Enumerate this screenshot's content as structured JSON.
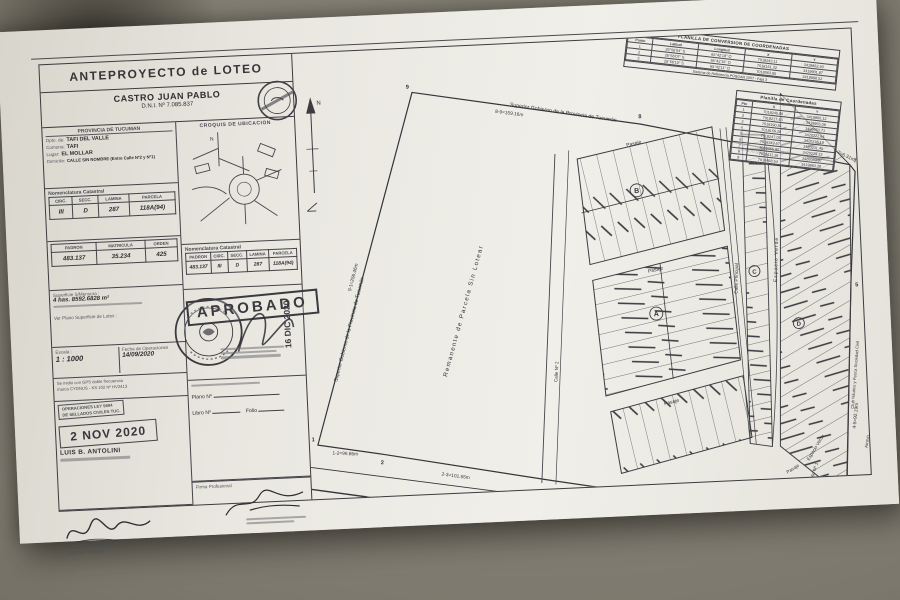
{
  "sheet": {
    "title": "ANTEPROYECTO de LOTEO",
    "owner": {
      "name": "CASTRO JUAN PABLO",
      "dni": "D.N.I. Nº 7.085.837"
    },
    "location": {
      "province": "PROVINCIA DE TUCUMAN",
      "rows": [
        {
          "label": "Dpto. de:",
          "value": "TAFI DEL VALLE"
        },
        {
          "label": "Comuna:",
          "value": "TAFI"
        },
        {
          "label": "Lugar:",
          "value": "EL MOLLAR"
        },
        {
          "label": "Domicilio:",
          "value": "CALLE SIN NOMBRE (Entre Calle Nº2 y Nº1)"
        }
      ]
    },
    "croquis_title": "CROQUIS DE UBICACION",
    "nomenclatura": {
      "title": "Nomenclatura Catastral",
      "headers": [
        "CIRC.",
        "SECC.",
        "LAMINA",
        "PARCELA"
      ],
      "values": [
        "III",
        "D",
        "287",
        "118A(94)"
      ]
    },
    "padron_table": {
      "headers": [
        "PADRON",
        "MATRICULA",
        "ORDEN"
      ],
      "values": [
        "483.137",
        "35.234",
        "425"
      ]
    },
    "superficie": {
      "label": "Superficie S/Mensura :",
      "value": "4 has. 8592.6828 m²",
      "note": "Ver Plano Superficie de Lotes :"
    },
    "nomenclatura2": {
      "title": "Nomenclatura Catastral",
      "headers": [
        "PADRON",
        "CIRC.",
        "SECC.",
        "LAMINA",
        "PARCELA"
      ],
      "values": [
        "483.137",
        "III",
        "D",
        "287",
        "118A(94)"
      ]
    },
    "aprobado": {
      "text": "APROBADO",
      "date": "16 DIC 2020"
    },
    "escala": {
      "label": "Escala :",
      "value": "1 : 1000"
    },
    "fecha": {
      "label": "Fecha de Operaciones",
      "value": "14/09/2020"
    },
    "gps_lines": [
      "Se midió con GPS doble frecuencia",
      "marca CYGNUS - KS 102 Nº HV2413"
    ],
    "ley_lines": [
      "OPERACIONES LEY 5694",
      "DE SELLADOS CIVILES TUC."
    ],
    "date_stamp": "2 NOV 2020",
    "surveyor": "LUIS B. ANTOLINI",
    "plano_box": {
      "plano": "Plano Nº",
      "libro": "Libro Nº",
      "folio": "Folio"
    },
    "firma_label": "Firma Profesional"
  },
  "plan": {
    "north": "N",
    "boundary_top": "Superior Gobierno de la Provincia de Tucumán",
    "boundary_left": "Superior Gobierno de la Provincia de Tucumán",
    "remanente": "Remanente de Parcela Sin Lotear",
    "pasaje": "Pasaje",
    "calle_principal": "Calle Principal",
    "calle_n2": "Calle Nº 2",
    "calle_n1": "Calle Nº 1",
    "calle_sin_nombre": "Calle Sin Nombre",
    "espacio_verde": "Espacio Verde",
    "club": "Club Náutico y Pesca Sociedad Civil",
    "arroyo": "Arroyo",
    "blocks": {
      "a": "A",
      "b": "B",
      "c": "C",
      "d": "D"
    },
    "measurements": {
      "m12": "1-2=99.86m",
      "m23": "2-3=101.65m",
      "m34": "3-4=172.71m",
      "m45": "4-5=92.19m",
      "m67": "6-7=6.31m",
      "m78": "7-8=156.93m",
      "m89": "8-9=159.16m",
      "m91": "9-1=256.46m"
    },
    "vertices": {
      "v1": "1",
      "v2": "2",
      "v3": "3",
      "v4": "4",
      "v5": "5",
      "v6": "6",
      "v7": "7",
      "v8": "8",
      "v9": "9"
    },
    "conv_table": {
      "title": "PLANILLA DE CONVERSION DE COORDENADAS",
      "headers": [
        "Punto",
        "Latitud",
        "Longitud",
        "X",
        "Y"
      ],
      "rows": [
        {
          "p": "1",
          "lat": "26°56'04\" S",
          "lon": "65°42'18\" O",
          "x": "7018243.11",
          "y": "3419862.40"
        },
        {
          "p": "2",
          "lat": "26°56'07\" S",
          "lon": "65°42'15\" O",
          "x": "7018151.32",
          "y": "3419901.87"
        },
        {
          "p": "3",
          "lat": "26°56'10\" S",
          "lon": "65°42'11\" O",
          "x": "7018063.95",
          "y": "3419998.52"
        }
      ],
      "note": "Sistema de Referencia POSGAR 2007 - Faja 3"
    },
    "coord_table": {
      "title": "Planilla de Coordenadas",
      "headers": [
        "Pto",
        "X",
        "Y"
      ],
      "rows": [
        {
          "p": "1",
          "x": "7018245.96",
          "y": "3419860.12"
        },
        {
          "p": "2",
          "x": "7018217.43",
          "y": "3419955.08"
        },
        {
          "p": "3",
          "x": "7018190.81",
          "y": "3420053.71"
        },
        {
          "p": "4",
          "x": "7018156.28",
          "y": "3420222.64"
        },
        {
          "p": "5",
          "x": "7018247.05",
          "y": "3420238.19"
        },
        {
          "p": "6",
          "x": "7018349.67",
          "y": "3420231.45"
        },
        {
          "p": "7",
          "x": "7018355.90",
          "y": "3420229.33"
        },
        {
          "p": "8",
          "x": "7018411.26",
          "y": "3420080.97"
        },
        {
          "p": "9",
          "x": "7018468.54",
          "y": "3419863.28"
        }
      ]
    }
  }
}
